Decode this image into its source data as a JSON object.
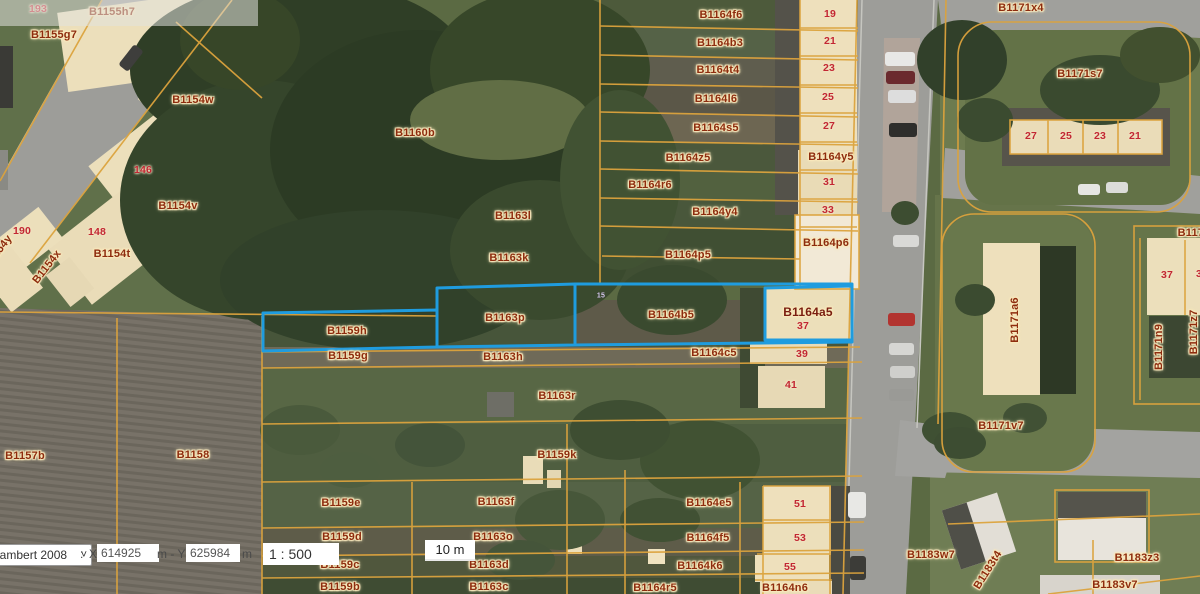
{
  "map": {
    "selection_color": "#1f9cdf",
    "parcel_line_color": "#dca33d",
    "selected_parcels": [
      "B1159h",
      "B1163p",
      "B1164b5",
      "B1164a5"
    ],
    "labels": [
      {
        "text": "193",
        "x": 38,
        "y": 9,
        "cls": "num"
      },
      {
        "text": "B1155h7",
        "x": 112,
        "y": 12
      },
      {
        "text": "B1155g7",
        "x": 54,
        "y": 35
      },
      {
        "text": "B1154w",
        "x": 193,
        "y": 100
      },
      {
        "text": "146",
        "x": 143,
        "y": 170,
        "cls": "num"
      },
      {
        "text": "B1154v",
        "x": 178,
        "y": 206
      },
      {
        "text": "190",
        "x": 22,
        "y": 231,
        "cls": "num"
      },
      {
        "text": "148",
        "x": 97,
        "y": 232,
        "cls": "num"
      },
      {
        "text": "B1154t",
        "x": 112,
        "y": 254
      },
      {
        "text": "B1154y",
        "x": -2,
        "y": 252,
        "rot": -52
      },
      {
        "text": "B1154x",
        "x": 47,
        "y": 267,
        "rot": -52
      },
      {
        "text": "B1160b",
        "x": 415,
        "y": 133
      },
      {
        "text": "B1163l",
        "x": 513,
        "y": 216
      },
      {
        "text": "B1163k",
        "x": 509,
        "y": 258
      },
      {
        "text": "B1164f6",
        "x": 721,
        "y": 15
      },
      {
        "text": "19",
        "x": 830,
        "y": 14,
        "cls": "num"
      },
      {
        "text": "B1164b3",
        "x": 720,
        "y": 43
      },
      {
        "text": "21",
        "x": 830,
        "y": 41,
        "cls": "num"
      },
      {
        "text": "B1164t4",
        "x": 718,
        "y": 70
      },
      {
        "text": "23",
        "x": 829,
        "y": 68,
        "cls": "num"
      },
      {
        "text": "B1164l6",
        "x": 716,
        "y": 99
      },
      {
        "text": "25",
        "x": 828,
        "y": 97,
        "cls": "num"
      },
      {
        "text": "B1164s5",
        "x": 716,
        "y": 128
      },
      {
        "text": "27",
        "x": 829,
        "y": 126,
        "cls": "num"
      },
      {
        "text": "B1164z5",
        "x": 688,
        "y": 158
      },
      {
        "text": "B1164y5",
        "x": 831,
        "y": 157
      },
      {
        "text": "B1164r6",
        "x": 650,
        "y": 185
      },
      {
        "text": "31",
        "x": 829,
        "y": 182,
        "cls": "num"
      },
      {
        "text": "B1164y4",
        "x": 715,
        "y": 212
      },
      {
        "text": "33",
        "x": 828,
        "y": 210,
        "cls": "num"
      },
      {
        "text": "B1164p5",
        "x": 688,
        "y": 255
      },
      {
        "text": "B1164p6",
        "x": 826,
        "y": 243
      },
      {
        "text": "B1171x4",
        "x": 1021,
        "y": 8
      },
      {
        "text": "B1171s7",
        "x": 1080,
        "y": 74
      },
      {
        "text": "27",
        "x": 1031,
        "y": 136,
        "cls": "num"
      },
      {
        "text": "25",
        "x": 1066,
        "y": 136,
        "cls": "num"
      },
      {
        "text": "23",
        "x": 1100,
        "y": 136,
        "cls": "num"
      },
      {
        "text": "21",
        "x": 1135,
        "y": 136,
        "cls": "num"
      },
      {
        "text": "B1171",
        "x": 1194,
        "y": 233
      },
      {
        "text": "37",
        "x": 1167,
        "y": 275,
        "cls": "num"
      },
      {
        "text": "3",
        "x": 1199,
        "y": 274,
        "cls": "num"
      },
      {
        "text": "B1171a6",
        "x": 1015,
        "y": 320,
        "rot": -90
      },
      {
        "text": "B1171n9",
        "x": 1159,
        "y": 347,
        "rot": -90
      },
      {
        "text": "B1171z7",
        "x": 1194,
        "y": 332,
        "rot": -90
      },
      {
        "text": "B1171v7",
        "x": 1001,
        "y": 426
      },
      {
        "text": "B1159h",
        "x": 347,
        "y": 331
      },
      {
        "text": "B1163p",
        "x": 505,
        "y": 318
      },
      {
        "text": "15",
        "x": 601,
        "y": 296,
        "cls": "tiny"
      },
      {
        "text": "B1164b5",
        "x": 671,
        "y": 315
      },
      {
        "text": "B1164a5",
        "x": 808,
        "y": 312,
        "cls": "bold"
      },
      {
        "text": "37",
        "x": 803,
        "y": 326,
        "cls": "num"
      },
      {
        "text": "B1159g",
        "x": 348,
        "y": 356
      },
      {
        "text": "B1163h",
        "x": 503,
        "y": 357
      },
      {
        "text": "B1164c5",
        "x": 714,
        "y": 353
      },
      {
        "text": "39",
        "x": 802,
        "y": 354,
        "cls": "num"
      },
      {
        "text": "41",
        "x": 791,
        "y": 385,
        "cls": "num"
      },
      {
        "text": "B1157b",
        "x": 25,
        "y": 456
      },
      {
        "text": "B1158",
        "x": 193,
        "y": 455
      },
      {
        "text": "B1163r",
        "x": 557,
        "y": 396
      },
      {
        "text": "B1159k",
        "x": 557,
        "y": 455
      },
      {
        "text": "B1159e",
        "x": 341,
        "y": 503
      },
      {
        "text": "B1163f",
        "x": 496,
        "y": 502
      },
      {
        "text": "B1159d",
        "x": 342,
        "y": 537
      },
      {
        "text": "B1163o",
        "x": 493,
        "y": 537
      },
      {
        "text": "B1159c",
        "x": 340,
        "y": 565
      },
      {
        "text": "B1163d",
        "x": 489,
        "y": 565
      },
      {
        "text": "B1159b",
        "x": 340,
        "y": 587
      },
      {
        "text": "B1163c",
        "x": 489,
        "y": 587
      },
      {
        "text": "B1164e5",
        "x": 709,
        "y": 503
      },
      {
        "text": "51",
        "x": 800,
        "y": 504,
        "cls": "num"
      },
      {
        "text": "B1164f5",
        "x": 708,
        "y": 538
      },
      {
        "text": "53",
        "x": 800,
        "y": 538,
        "cls": "num"
      },
      {
        "text": "B1164k6",
        "x": 700,
        "y": 566
      },
      {
        "text": "55",
        "x": 790,
        "y": 567,
        "cls": "num"
      },
      {
        "text": "B1164r5",
        "x": 655,
        "y": 588
      },
      {
        "text": "B1164n6",
        "x": 785,
        "y": 588
      },
      {
        "text": "B1183w7",
        "x": 931,
        "y": 555
      },
      {
        "text": "B1183t4",
        "x": 988,
        "y": 570,
        "rot": -58
      },
      {
        "text": "B1183z3",
        "x": 1137,
        "y": 558
      },
      {
        "text": "B1183v7",
        "x": 1115,
        "y": 585
      }
    ]
  },
  "controls": {
    "crs_selected": "Lambert 2008",
    "colon": ":",
    "x_label": "X",
    "x_value": "614925",
    "unit_between": "m - Y",
    "y_value": "625984",
    "unit_after": "m",
    "scale_value": "1 : 500",
    "scalebar_label": "10 m"
  }
}
